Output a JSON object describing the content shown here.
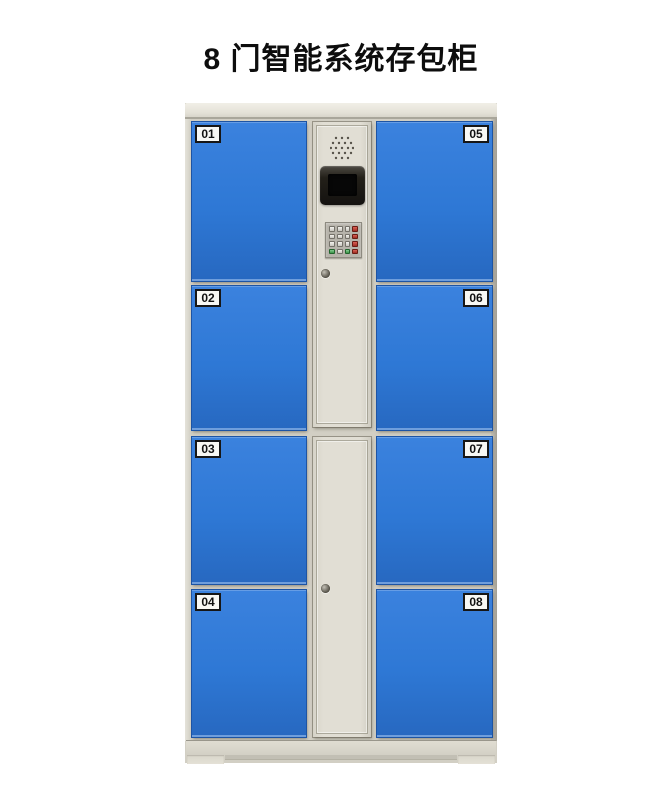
{
  "page": {
    "title": "8 门智能系统存包柜"
  },
  "cabinet": {
    "description": "8-door smart storage locker, cream frame with blue doors",
    "doors": [
      {
        "label": "01",
        "column": "left",
        "row": 1
      },
      {
        "label": "02",
        "column": "left",
        "row": 2
      },
      {
        "label": "03",
        "column": "left",
        "row": 3
      },
      {
        "label": "04",
        "column": "left",
        "row": 4
      },
      {
        "label": "05",
        "column": "right",
        "row": 1
      },
      {
        "label": "06",
        "column": "right",
        "row": 2
      },
      {
        "label": "07",
        "column": "right",
        "row": 3
      },
      {
        "label": "08",
        "column": "right",
        "row": 4
      }
    ],
    "control_panel": {
      "components": [
        "speaker-grille",
        "lcd-display",
        "keypad",
        "keyhole-lock"
      ],
      "keypad_layout": [
        [
          "light",
          "light",
          "light",
          "red"
        ],
        [
          "light",
          "light",
          "light",
          "red"
        ],
        [
          "light",
          "light",
          "light",
          "red"
        ],
        [
          "green",
          "light",
          "green",
          "red"
        ]
      ],
      "lock_count": 2
    },
    "colors": {
      "door_blue": "#2e78d5",
      "door_border": "#1d54a4",
      "frame_beige": "#d2cfc4",
      "frame_light": "#ebe9e0",
      "label_bg": "#f8f8f4",
      "label_text": "#111111",
      "keypad_red": "#a02c21",
      "keypad_green": "#3b9449",
      "screen_black": "#141210"
    }
  }
}
